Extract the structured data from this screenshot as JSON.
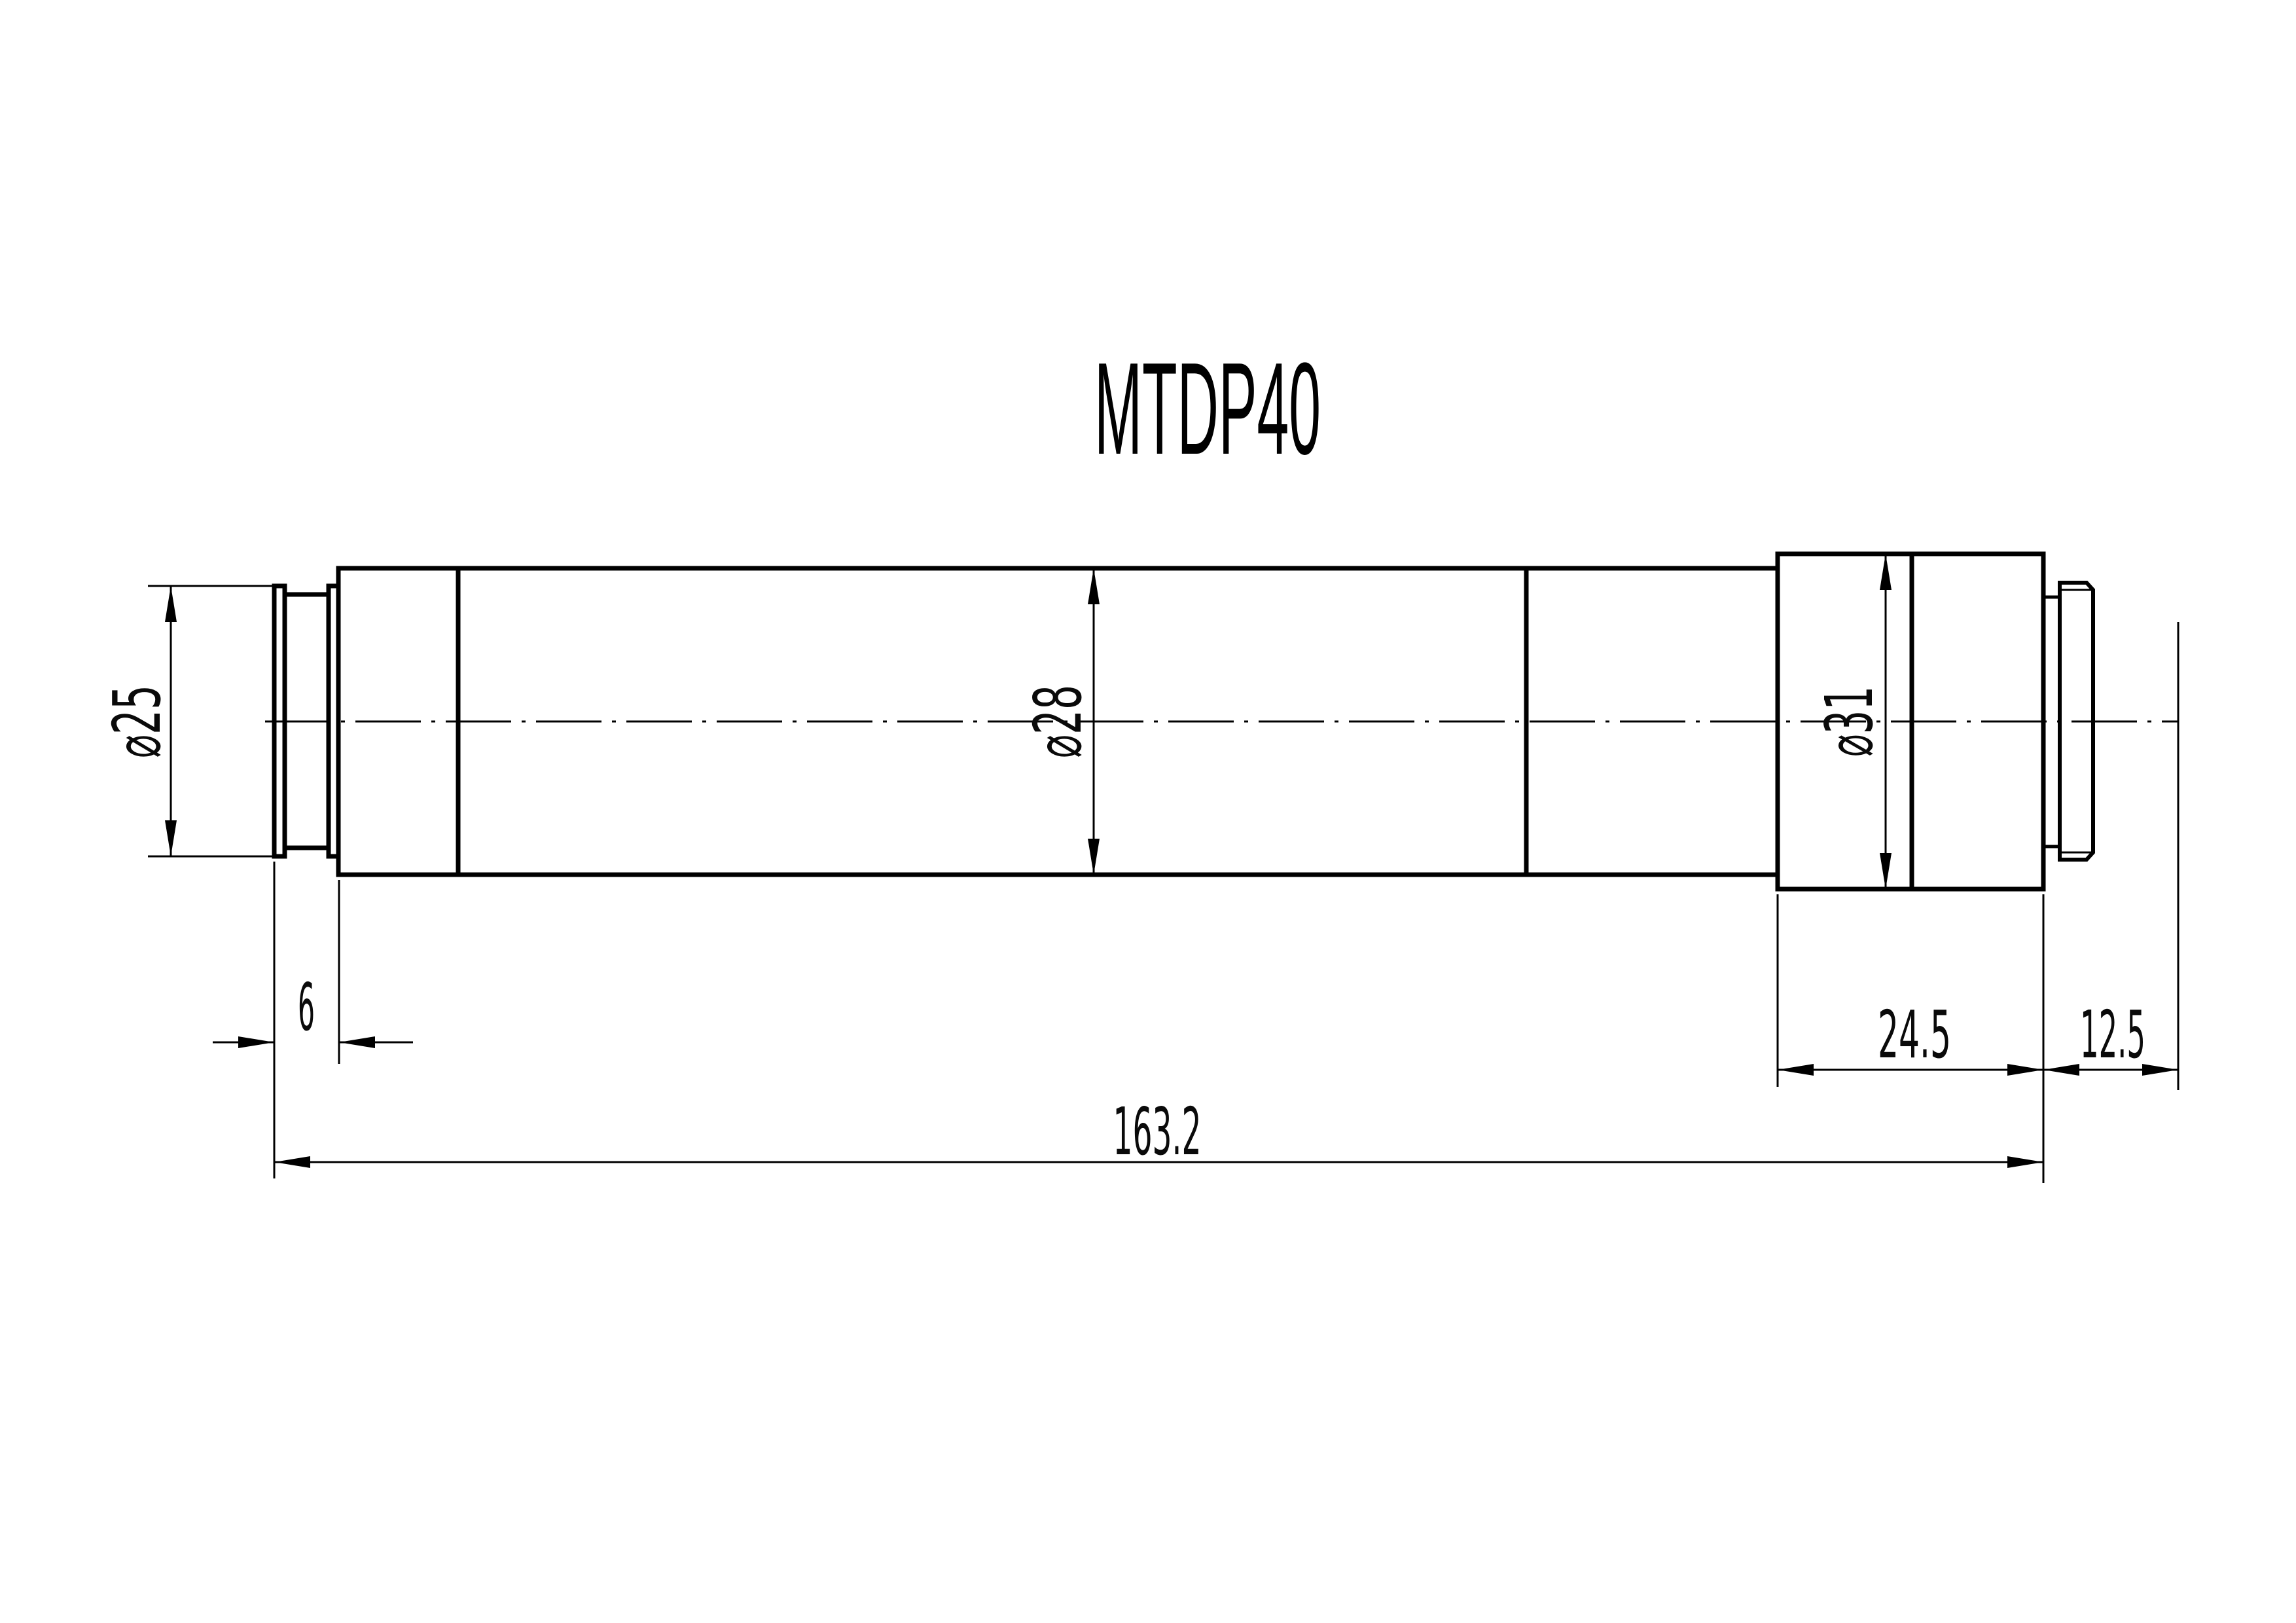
{
  "title": "MTDP40",
  "colors": {
    "line": "#000000",
    "background": "#ffffff"
  },
  "dimensions": {
    "dia_front": {
      "label": "⌀25"
    },
    "dia_main": {
      "label": "⌀28"
    },
    "dia_mount": {
      "label": "⌀31"
    },
    "front_step_length": {
      "label": "6"
    },
    "mount_block_length": {
      "label": "24.5"
    },
    "rear_offset_length": {
      "label": "12.5"
    },
    "total_length": {
      "label": "163.2"
    }
  }
}
